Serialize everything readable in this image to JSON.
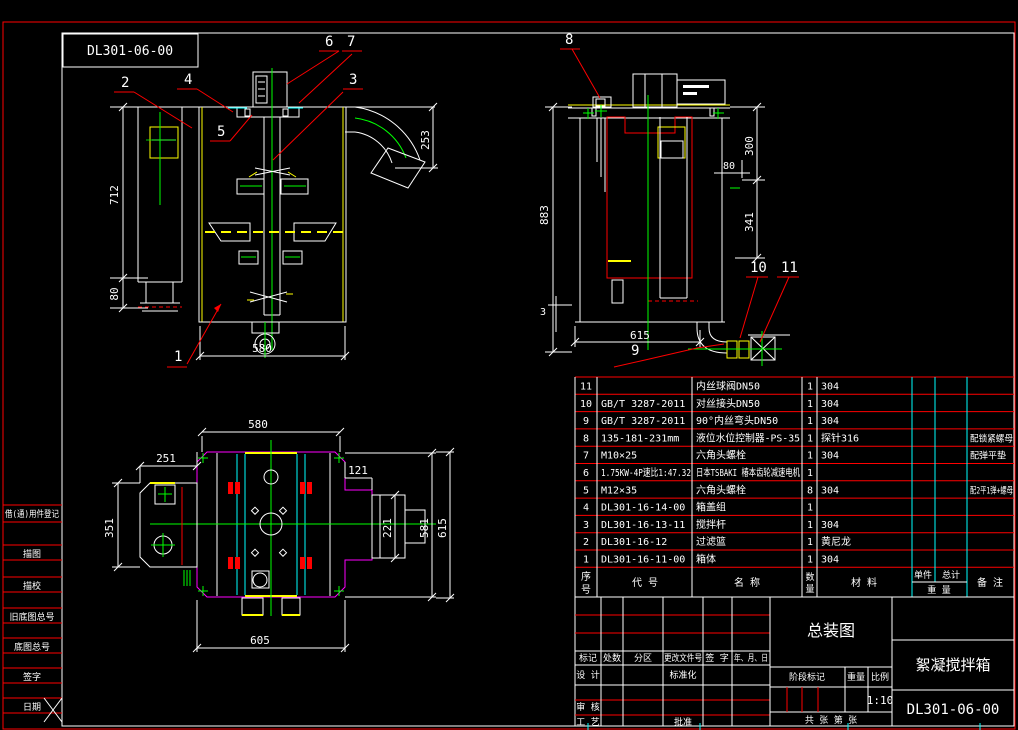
{
  "colors": {
    "line": "#ffffff",
    "accent_red": "#ff0000",
    "accent_green": "#00ff00",
    "accent_yellow": "#ffff00",
    "accent_cyan": "#00ffff",
    "accent_magenta": "#ff00ff",
    "background": "#000000"
  },
  "sheet": {
    "number_box": "DL301-06-00"
  },
  "margin_fields": {
    "items": [
      "借(通)用件登记",
      "描图",
      "描校",
      "旧底图总号",
      "底图总号",
      "签字",
      "日期"
    ]
  },
  "front_view": {
    "callouts": {
      "c1": "1",
      "c2": "2",
      "c3": "3",
      "c4": "4",
      "c5": "5",
      "c6": "6",
      "c7": "7"
    },
    "dims": {
      "height": "712",
      "foot": "80",
      "width": "580",
      "elbow": "253"
    }
  },
  "side_view": {
    "callouts": {
      "c8": "8",
      "c9": "9",
      "c10": "10",
      "c11": "11"
    },
    "dims": {
      "height": "883",
      "top": "300",
      "mid": "341",
      "nozzle": "80",
      "gap": "3",
      "width": "615"
    }
  },
  "plan_view": {
    "dims": {
      "top": "580",
      "left_w": "251",
      "left_h": "351",
      "right_w": "121",
      "right_h": "221",
      "inner_h": "581",
      "outer_h": "615",
      "bottom": "605"
    }
  },
  "bom": {
    "headers": {
      "no": "序号",
      "no_top": "序",
      "no_bottom": "号",
      "code": "代 号",
      "name": "名 称",
      "qty": "数量",
      "qty_top": "数",
      "qty_bottom": "量",
      "material": "材 料",
      "unit": "单件",
      "total": "总计",
      "weight": "重 量",
      "remark": "备 注"
    },
    "rows": [
      {
        "no": "11",
        "code": "",
        "name": "内丝球阀DN50",
        "qty": "1",
        "material": "304",
        "remark": ""
      },
      {
        "no": "10",
        "code": "GB/T 3287-2011",
        "name": "对丝接头DN50",
        "qty": "1",
        "material": "304",
        "remark": ""
      },
      {
        "no": "9",
        "code": "GB/T 3287-2011",
        "name": "90°内丝弯头DN50",
        "qty": "1",
        "material": "304",
        "remark": ""
      },
      {
        "no": "8",
        "code": "135-181-231mm",
        "name": "液位水位控制器-PS-35",
        "qty": "1",
        "material": "探针316",
        "remark": "配锁紧螺母"
      },
      {
        "no": "7",
        "code": "M10×25",
        "name": "六角头螺栓",
        "qty": "1",
        "material": "304",
        "remark": "配弹平垫"
      },
      {
        "no": "6",
        "code": "1.75KW-4P速比1:47.32",
        "name": "日本TSBAKI 椿本齿轮减速电机",
        "qty": "1",
        "material": "",
        "remark": ""
      },
      {
        "no": "5",
        "code": "M12×35",
        "name": "六角头螺栓",
        "qty": "8",
        "material": "304",
        "remark": "配2平1弹+螺母"
      },
      {
        "no": "4",
        "code": "DL301-16-14-00",
        "name": "箱盖组",
        "qty": "1",
        "material": "",
        "remark": ""
      },
      {
        "no": "3",
        "code": "DL301-16-13-11",
        "name": "搅拌杆",
        "qty": "1",
        "material": "304",
        "remark": ""
      },
      {
        "no": "2",
        "code": "DL301-16-12",
        "name": "过滤篮",
        "qty": "1",
        "material": "黄尼龙",
        "remark": ""
      },
      {
        "no": "1",
        "code": "DL301-16-11-00",
        "name": "箱体",
        "qty": "1",
        "material": "304",
        "remark": ""
      }
    ]
  },
  "title_block": {
    "revision_headers": [
      "标记",
      "处数",
      "分区",
      "更改文件号",
      "签 字",
      "年、月、日"
    ],
    "roles": {
      "design": "设 计",
      "standard": "标准化",
      "audit": "审 核",
      "process": "工 艺",
      "approve": "批准"
    },
    "stage_label": "阶段标记",
    "weight_label": "重量",
    "scale_label": "比例",
    "scale_value": "1:10",
    "sheet_info": "共 张 第 张",
    "title": "总装图",
    "product": "絮凝搅拌箱",
    "drawing_no": "DL301-06-00"
  }
}
